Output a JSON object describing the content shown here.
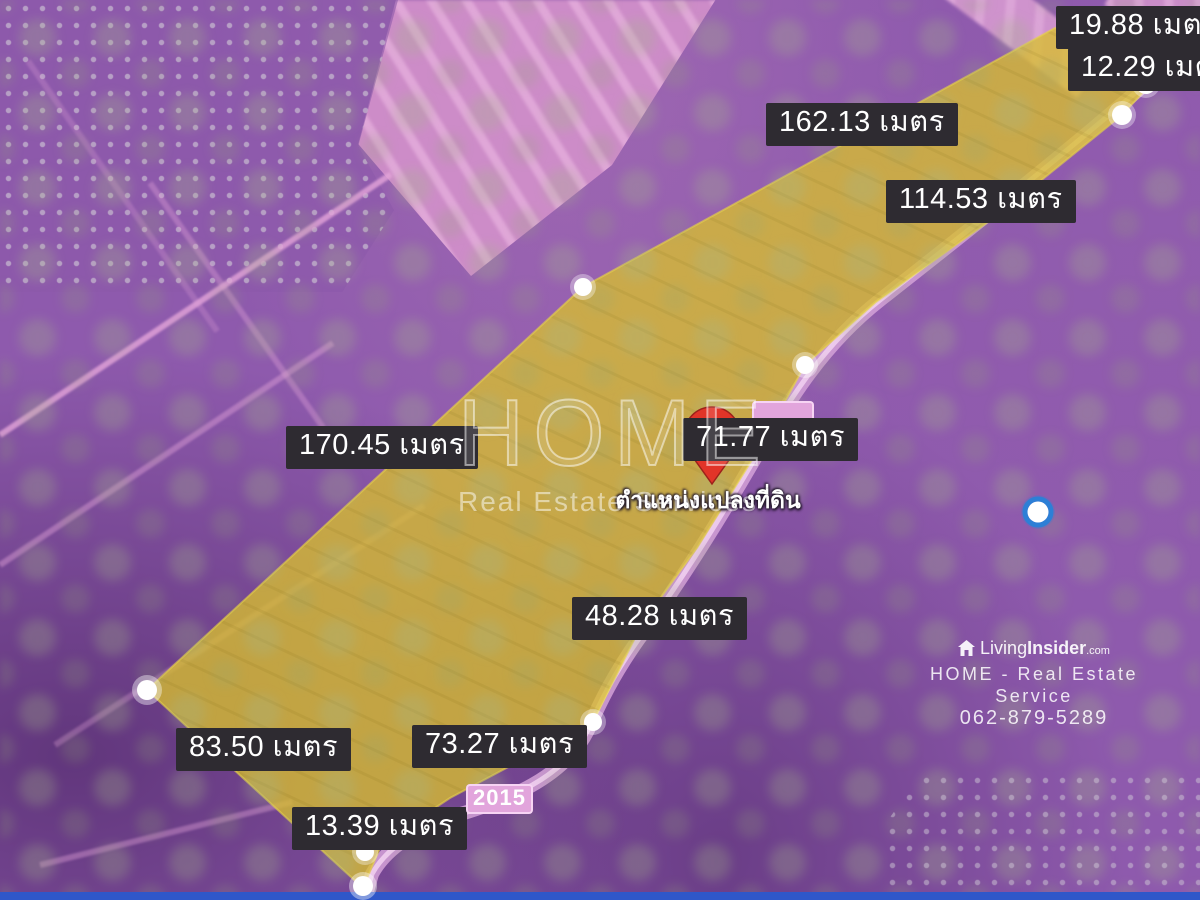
{
  "map": {
    "type": "satellite-land-plot-listing",
    "unit_word": "เมตร",
    "colors": {
      "map_base": "#8e5aad",
      "plot_fill": "#d9bf2e",
      "plot_edge": "#e8d34a",
      "label_bg": "#2e2b31",
      "label_text": "#ffffff",
      "pin_red": "#e23428",
      "pin_core": "#7e1a14",
      "road_pink": "#d5a2d8",
      "road_badge_bg": "#e2a5dc",
      "gps_blue": "#2d7fd6",
      "bottom_bar": "#2f57c9",
      "tree_green": "#a5b68a"
    }
  },
  "measurements": [
    "19.88 เมตร",
    "12.29 เมตร",
    "162.13 เมตร",
    "114.53 เมตร",
    "170.45 เมตร",
    "71.77 เมตร",
    "48.28 เมตร",
    "73.27 เมตร",
    "83.50 เมตร",
    "13.39 เมตร"
  ],
  "pin": {
    "caption": "ตำแหน่งแปลงที่ดิน"
  },
  "road_badge": {
    "text": "2015"
  },
  "watermark_center": {
    "title": "HOME",
    "subtitle": "Real Estate Services"
  },
  "brand": {
    "name_light": "Living",
    "name_bold": "Insider",
    "name_suffix": ".com",
    "service_line": "HOME - Real Estate Service",
    "phone": "062-879-5289"
  },
  "icons": {
    "pin": "location-pin-icon",
    "gps": "gps-dot-icon",
    "house": "house-icon",
    "vertex": "vertex-dot"
  }
}
